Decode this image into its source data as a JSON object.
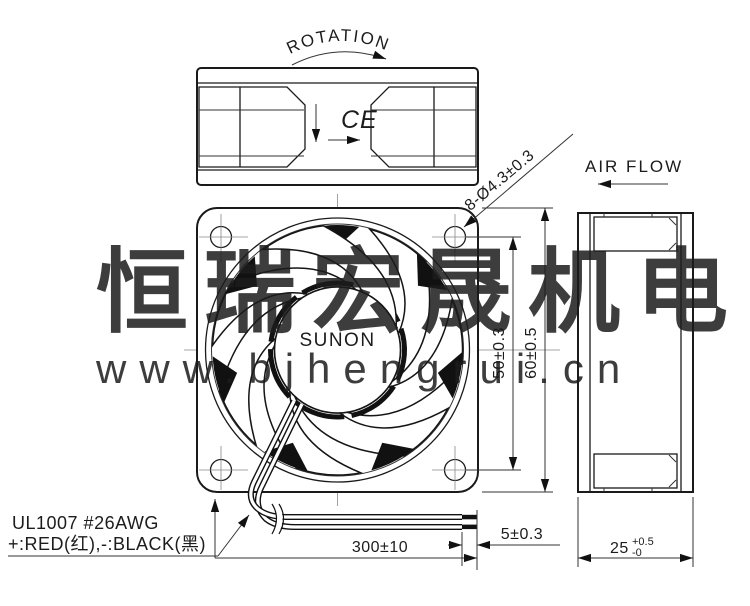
{
  "labels": {
    "rotation": "ROTATION",
    "air_flow": "AIR FLOW",
    "brand": "SUNON",
    "ce_mark": "CE",
    "wire_spec_line1": "UL1007  #26AWG",
    "wire_spec_line2": "+:RED(红),-:BLACK(黑)"
  },
  "dimensions": {
    "mounting_holes": "8-Ø4.3±0.3",
    "hole_pitch": "50±0.3",
    "frame_size": "60±0.5",
    "lead_length": "300±10",
    "strip_length": "5±0.3",
    "depth": {
      "value": "25",
      "tol_plus": "+0.5",
      "tol_minus": "-0"
    }
  },
  "watermark": {
    "company": "恒瑞宏晟机电",
    "url": "www.bjhengrui.cn"
  },
  "colors": {
    "line": "#1a1a1a",
    "watermark": "#e7e7e7",
    "background": "#ffffff"
  }
}
